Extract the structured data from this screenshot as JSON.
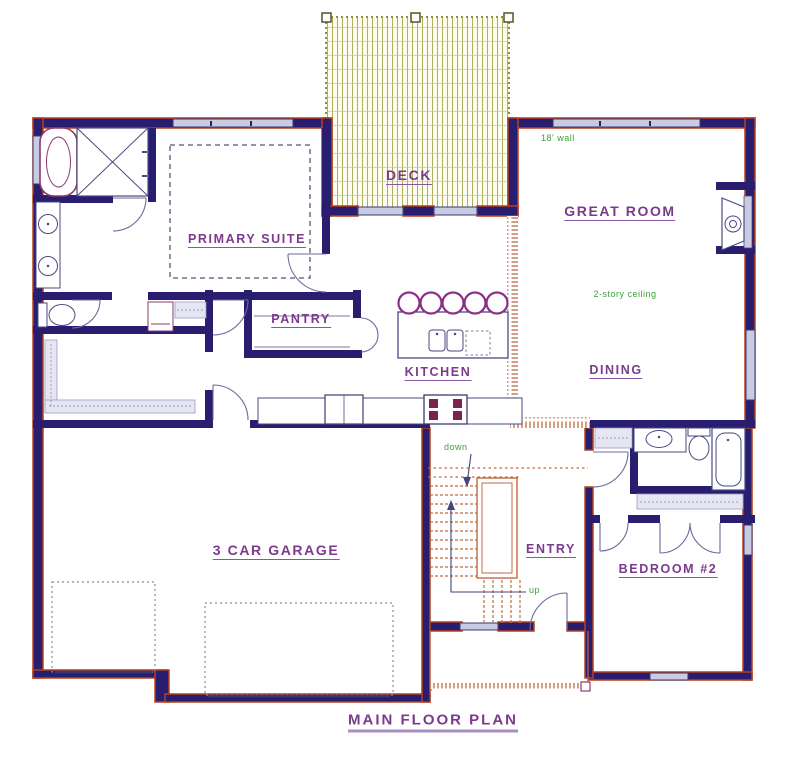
{
  "title": "MAIN FLOOR PLAN",
  "rooms": {
    "deck": "DECK",
    "great_room": "GREAT ROOM",
    "primary_suite": "PRIMARY SUITE",
    "pantry": "PANTRY",
    "kitchen": "KITCHEN",
    "dining": "DINING",
    "garage": "3 CAR GARAGE",
    "entry": "ENTRY",
    "bedroom2": "BEDROOM #2"
  },
  "annotations": {
    "wall_note": "18' wall",
    "ceiling_note": "2-story ceiling",
    "stair_down": "down",
    "stair_up": "up"
  },
  "colors": {
    "wall": "#281d6e",
    "wall_edge": "#b5401f",
    "room_label": "#7c3a8d",
    "annotation_green": "#3da03d",
    "deck_hatch": "#a8a84c",
    "stair_orange": "#c06a42",
    "window_fill": "#c9cbe2",
    "fixture_outline": "#4a4a80",
    "shelf_fill": "#e6e6f2"
  }
}
